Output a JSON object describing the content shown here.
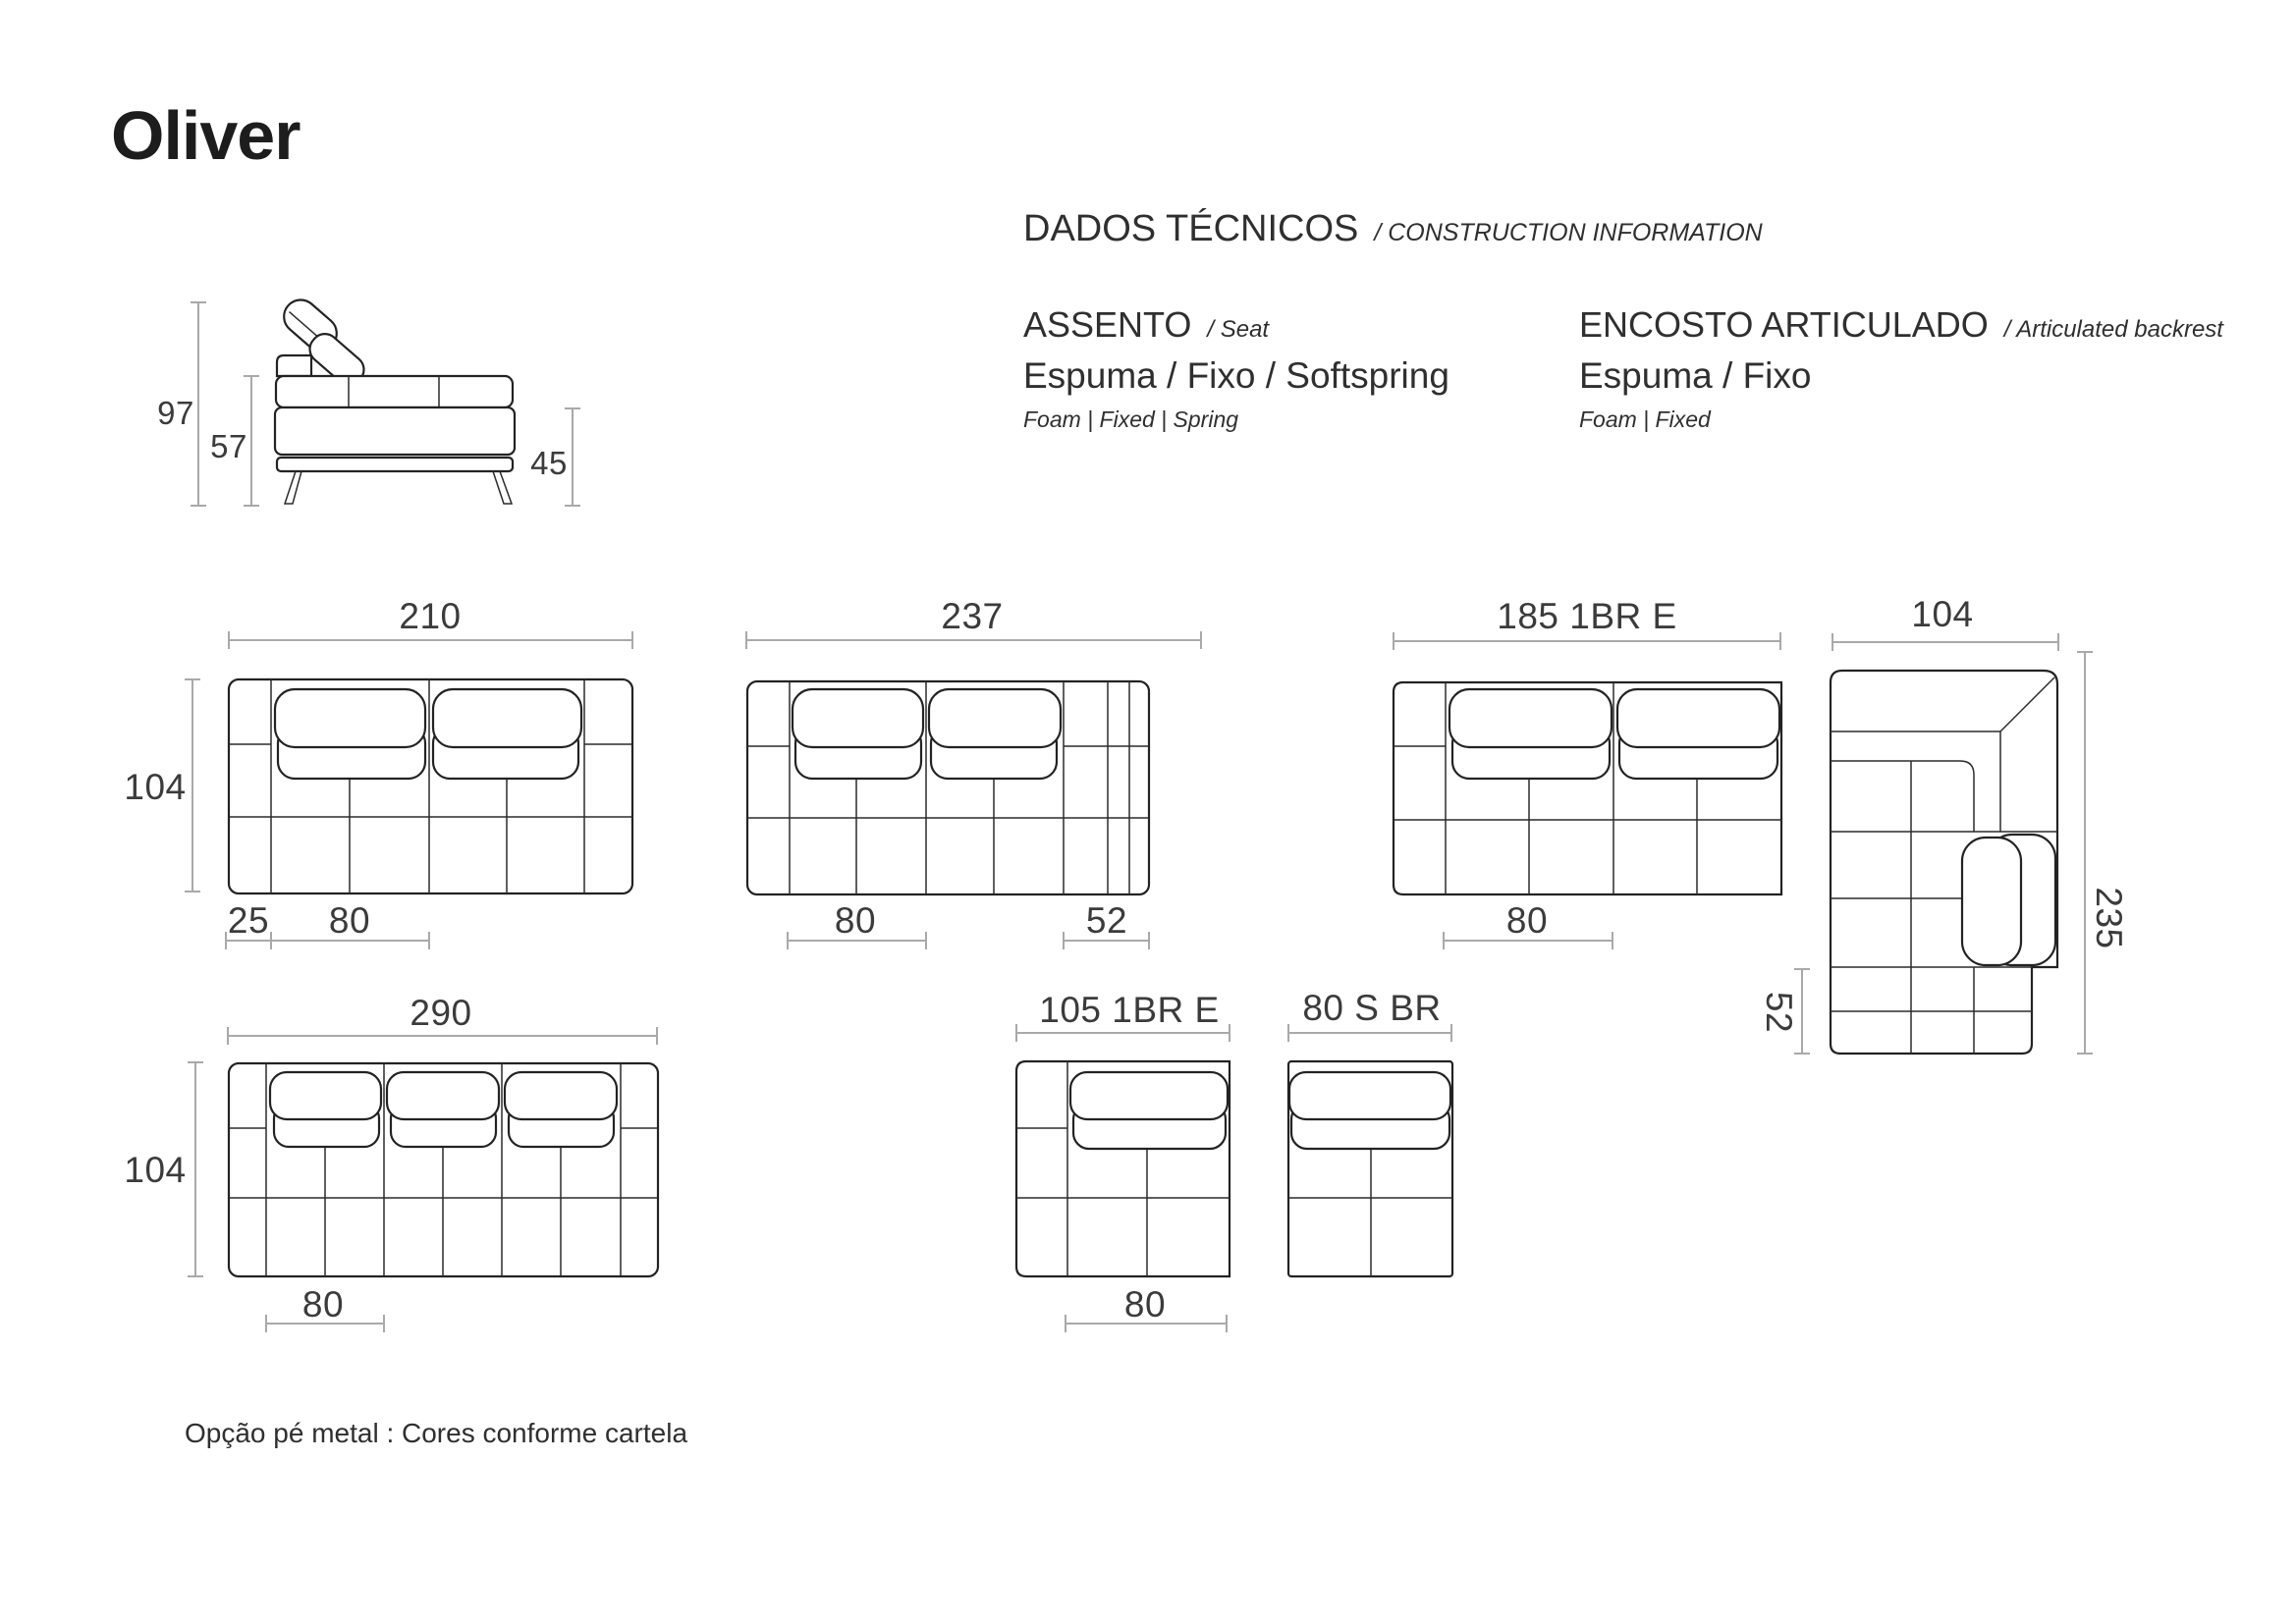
{
  "page": {
    "title": "Oliver",
    "footnote": "Opção pé metal : Cores conforme cartela"
  },
  "tech_info": {
    "heading_pt": "DADOS TÉCNICOS",
    "heading_en": "/ CONSTRUCTION INFORMATION",
    "seat": {
      "title_pt": "ASSENTO",
      "title_en": "/ Seat",
      "spec_pt": "Espuma / Fixo / Softspring",
      "spec_en": "Foam | Fixed | Spring"
    },
    "backrest": {
      "title_pt": "ENCOSTO ARTICULADO",
      "title_en": "/ Articulated backrest",
      "spec_pt": "Espuma / Fixo",
      "spec_en": "Foam | Fixed"
    }
  },
  "side_view": {
    "total_height": "97",
    "back_height": "57",
    "seat_height": "45"
  },
  "modules": {
    "m210": {
      "width": "210",
      "depth": "104",
      "arm": "25",
      "seat": "80"
    },
    "m237": {
      "width": "237",
      "seat": "80",
      "end": "52"
    },
    "m185": {
      "width": "185 1BR E",
      "seat": "80"
    },
    "corner": {
      "width": "104",
      "length": "235",
      "strip": "52"
    },
    "m290": {
      "width": "290",
      "depth": "104",
      "seat": "80"
    },
    "m105": {
      "width": "105 1BR E",
      "seat": "80"
    },
    "m80": {
      "width": "80 S BR"
    }
  },
  "colors": {
    "background": "#ffffff",
    "outline": "#232323",
    "dim_line": "#a9a9a9",
    "label": "#3b3b3b"
  }
}
